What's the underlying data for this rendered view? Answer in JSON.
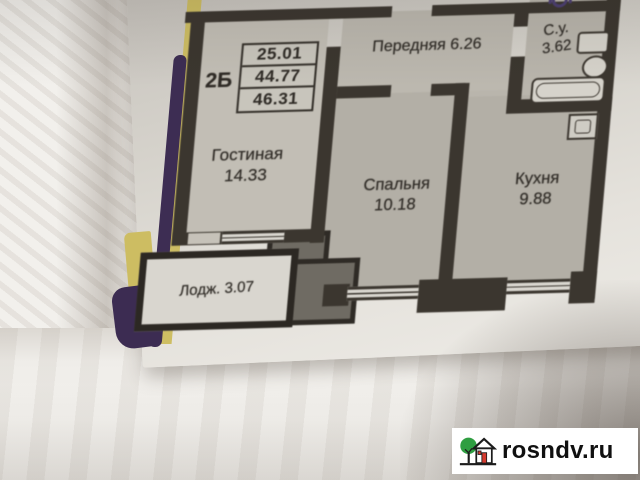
{
  "watermark": {
    "text": "rosndv.ru"
  },
  "plan": {
    "unit": {
      "label": "2Б",
      "values": [
        "25.01",
        "44.77",
        "46.31"
      ]
    },
    "rooms": {
      "hallway": {
        "label": "Передняя",
        "area": "6.26"
      },
      "bathroom": {
        "label": "С.у.",
        "area": "3.62"
      },
      "living": {
        "label": "Гостиная",
        "area": "14.33"
      },
      "bedroom": {
        "label": "Спальня",
        "area": "10.18"
      },
      "kitchen": {
        "label": "Кухня",
        "area": "9.88"
      },
      "loggia": {
        "label": "Лодж.",
        "area": "3.07"
      }
    },
    "fixtures": [
      "sink",
      "toilet",
      "bathtub",
      "stove"
    ],
    "colors": {
      "wall": "#3b362f",
      "floor": "#bcb8b0",
      "paper": "#e2dfd9",
      "structure_mass": "#6f6b63",
      "edge_yellow": "#cebe63",
      "edge_purple": "#3c2c52",
      "logo_green": "#2f9e41",
      "logo_red": "#d63a2f"
    }
  }
}
